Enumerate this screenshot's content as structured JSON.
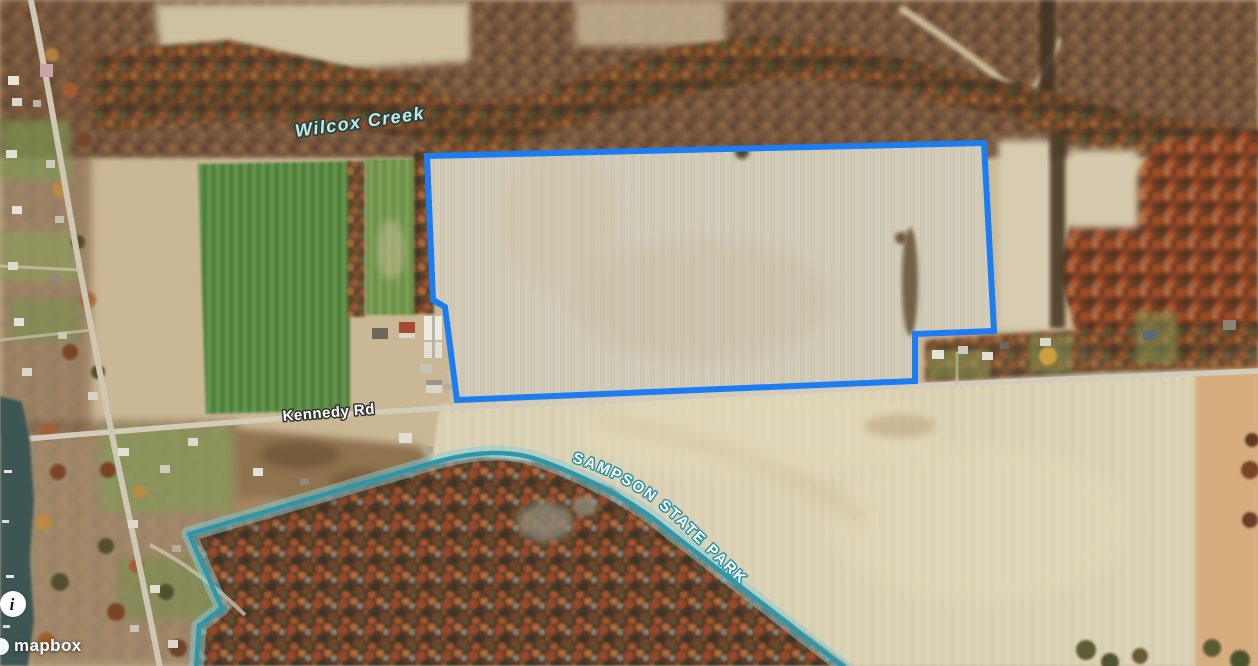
{
  "map": {
    "labels": {
      "creek": "Wilcox Creek",
      "road": "Kennedy Rd",
      "park": "SAMPSON STATE PARK"
    },
    "colors": {
      "parcel_outline": "#1c7df2",
      "park_boundary": "#2d96a8",
      "park_boundary_glow": "#86ced6",
      "creek_label": "#c2ebe4",
      "road_label": "#ffffff",
      "park_label": "#ffffff",
      "water": "#3c5752"
    }
  },
  "attribution": {
    "brand": "mapbox",
    "info_glyph": "i"
  }
}
